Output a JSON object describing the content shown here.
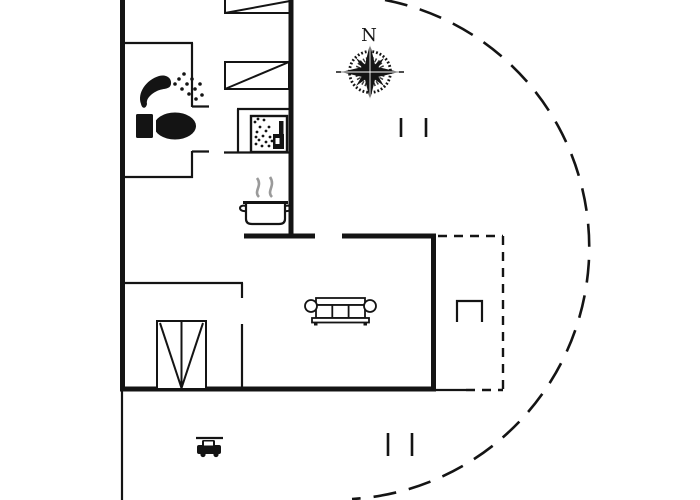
{
  "compass": {
    "north_label": "N"
  },
  "palette": {
    "ink": "#141414",
    "steam": "#9a9a9a",
    "background": "#ffffff"
  },
  "icons": [
    {
      "name": "compass-rose"
    },
    {
      "name": "shower-icon"
    },
    {
      "name": "toilet-icon"
    },
    {
      "name": "wood-stove-icon"
    },
    {
      "name": "cooking-pot-icon"
    },
    {
      "name": "steam-icon"
    },
    {
      "name": "single-bed-icon",
      "count": 2
    },
    {
      "name": "wardrobe-double-door-icon"
    },
    {
      "name": "sofa-icon"
    },
    {
      "name": "garden-bench-icon"
    },
    {
      "name": "car-icon"
    },
    {
      "name": "window-tick-marks",
      "count": 2
    }
  ]
}
